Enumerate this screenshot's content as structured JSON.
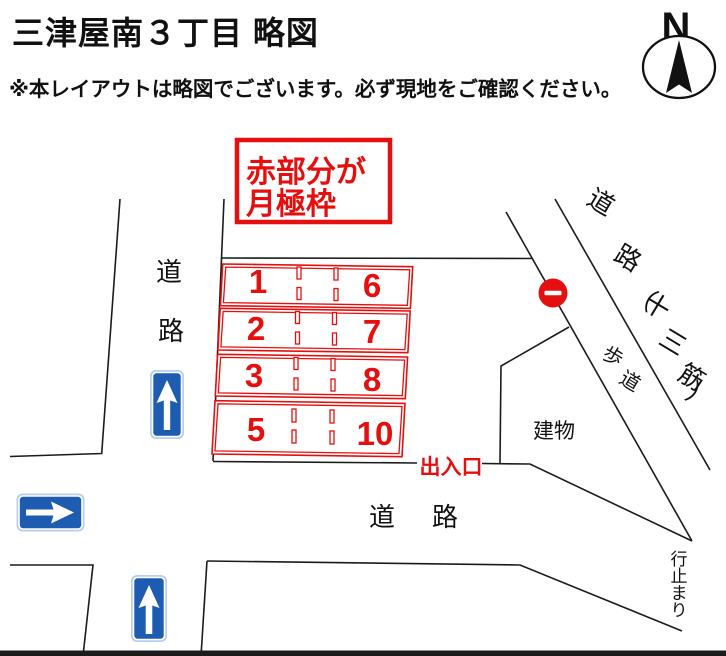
{
  "header": {
    "title": "三津屋南３丁目 略図",
    "disclaimer": "※本レイアウトは略図でございます。必ず現地をご確認ください。"
  },
  "compass": {
    "label": "N"
  },
  "legend": {
    "line1": "赤部分が",
    "line2": "月極枠"
  },
  "parking": {
    "rows": [
      {
        "left": "1",
        "right": "6"
      },
      {
        "left": "2",
        "right": "7"
      },
      {
        "left": "3",
        "right": "8"
      },
      {
        "left": "5",
        "right": "10"
      }
    ],
    "entrance_label": "出入口"
  },
  "roads": {
    "left_vertical": [
      "道",
      "路"
    ],
    "bottom_horizontal": [
      "道",
      "路"
    ],
    "main_diagonal_label": [
      "道",
      "路",
      "（",
      "十",
      "三",
      "筋",
      "）"
    ],
    "sidewalk_label": [
      "歩",
      "道"
    ],
    "dead_end_label": [
      "行",
      "止",
      "ま",
      "り"
    ],
    "building_label": "建物"
  },
  "colors": {
    "parking_red": "#e60f0f",
    "sign_blue": "#1d5cb0",
    "no_entry_red": "#e60f0f",
    "line_black": "#1b1b1b"
  }
}
